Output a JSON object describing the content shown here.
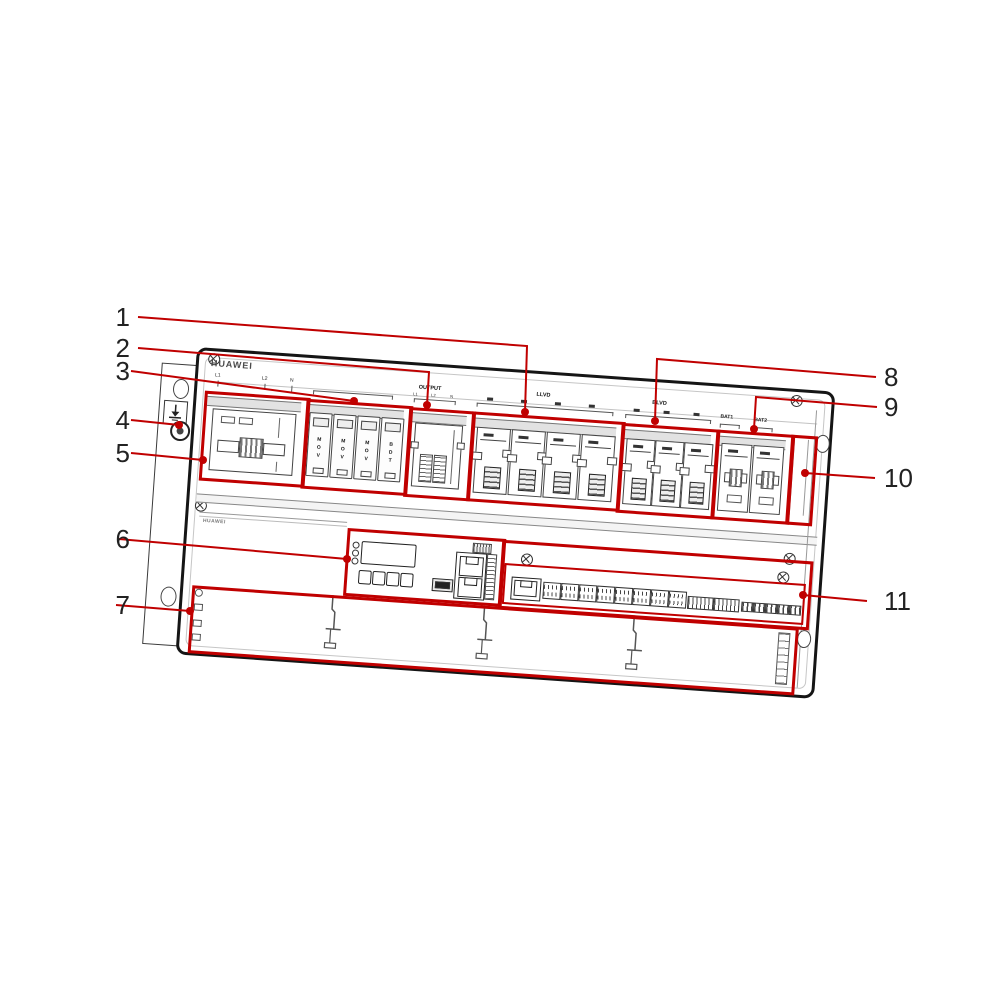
{
  "figure": {
    "type": "hardware-callout-diagram",
    "device_brand": "HUAWEI",
    "device_brand_small": "HUAWEI",
    "callouts": [
      {
        "label": "1"
      },
      {
        "label": "2"
      },
      {
        "label": "3"
      },
      {
        "label": "4"
      },
      {
        "label": "5"
      },
      {
        "label": "6"
      },
      {
        "label": "7"
      },
      {
        "label": "8"
      },
      {
        "label": "9"
      },
      {
        "label": "10"
      },
      {
        "label": "11"
      }
    ],
    "panel_labels": {
      "ac_input_poles": [
        "L1",
        "L2",
        "N"
      ],
      "output_group_label": "OUTPUT",
      "output_poles": [
        "L1",
        "L2",
        "N"
      ],
      "load_group_1_label": "LLVD",
      "load_group_2_label": "BLVD",
      "battery_breaker_labels": [
        "BAT1",
        "BAT2"
      ]
    },
    "spd_module_labels": [
      "MOV",
      "MOV",
      "MOV",
      "BDT"
    ],
    "colors": {
      "callout_red": "#c00000",
      "chassis_line": "#151515"
    }
  }
}
